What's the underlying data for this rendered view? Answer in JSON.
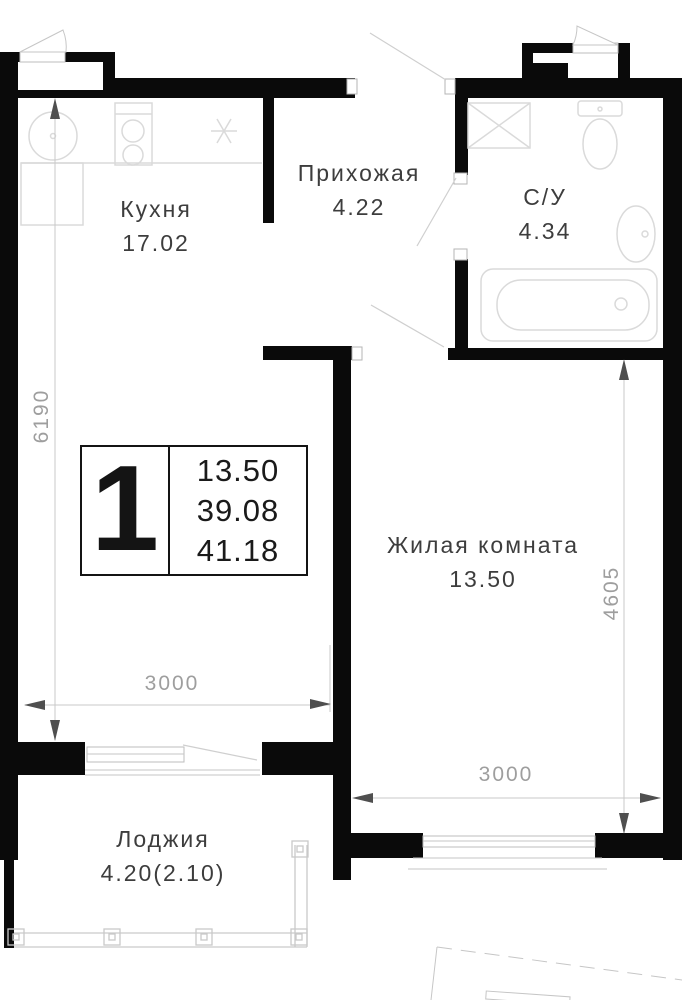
{
  "plan": {
    "stamp": {
      "type_label": "1",
      "living_area": "13.50",
      "area_without_balcony": "39.08",
      "total_area": "41.18"
    },
    "rooms": [
      {
        "id": "kitchen",
        "name": "Кухня",
        "area": "17.02"
      },
      {
        "id": "hallway",
        "name": "Прихожая",
        "area": "4.22"
      },
      {
        "id": "bathroom",
        "name": "С/У",
        "area": "4.34"
      },
      {
        "id": "living",
        "name": "Жилая комната",
        "area": "13.50"
      },
      {
        "id": "loggia",
        "name": "Лоджия",
        "area": "4.20(2.10)"
      }
    ],
    "dimensions": {
      "kitchen_height": "6190",
      "kitchen_width": "3000",
      "living_height": "4605",
      "living_width": "3000"
    },
    "colors": {
      "walls": "#0a0a0a",
      "room_labels": "#3d3d3d",
      "dimension_labels": "#9e9e9e"
    }
  }
}
